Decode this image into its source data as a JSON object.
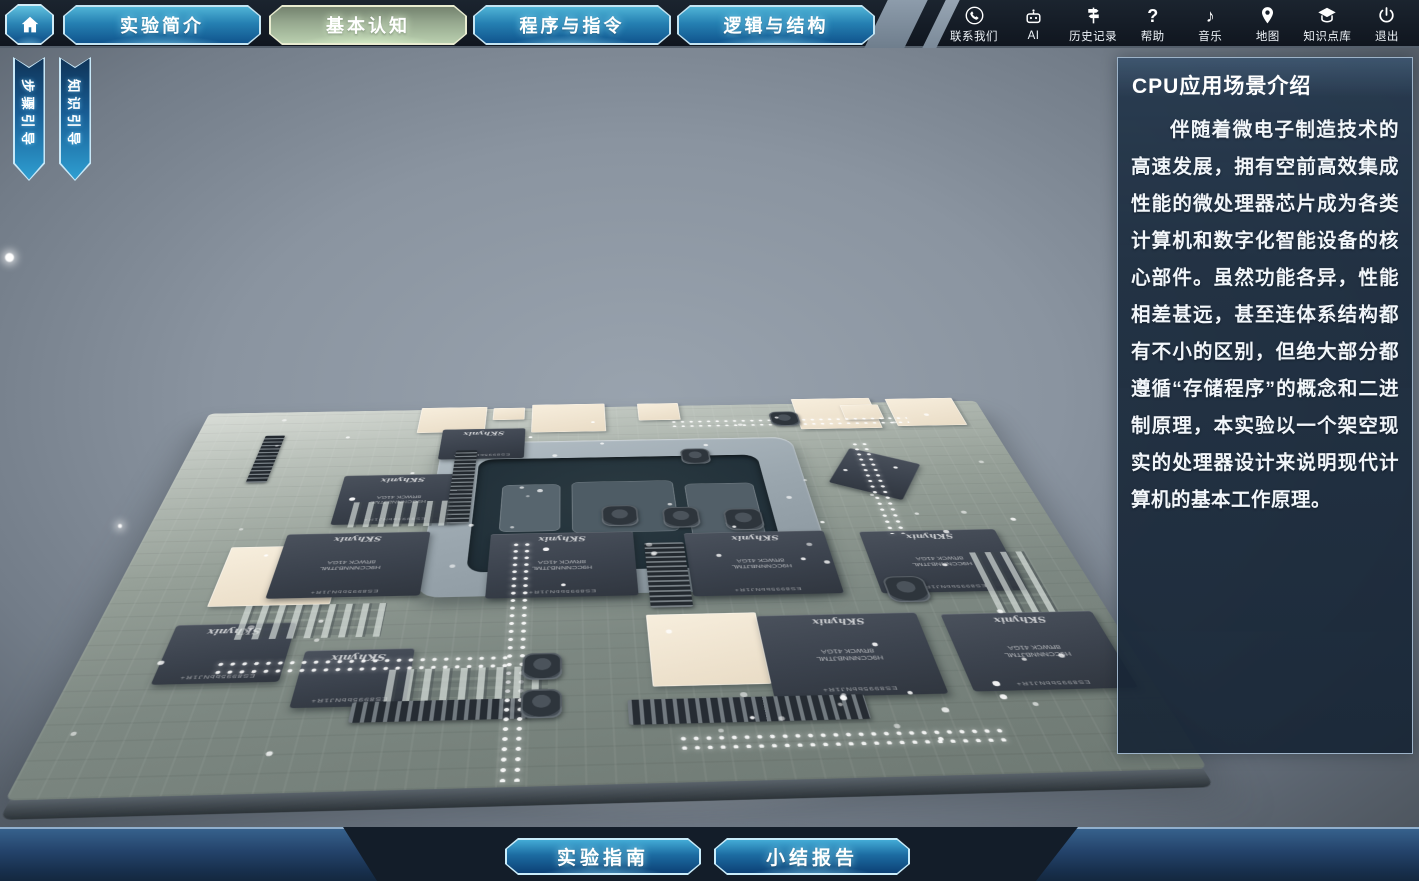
{
  "topbar": {
    "tabs": [
      {
        "label": "实验简介",
        "active": false
      },
      {
        "label": "基本认知",
        "active": true
      },
      {
        "label": "程序与指令",
        "active": false
      },
      {
        "label": "逻辑与结构",
        "active": false
      }
    ],
    "utilities": [
      {
        "label": "联系我们",
        "icon": "contact-phone-icon"
      },
      {
        "label": "AI",
        "icon": "ai-robot-icon"
      },
      {
        "label": "历史记录",
        "icon": "history-signpost-icon"
      },
      {
        "label": "帮助",
        "icon": "help-question-icon",
        "glyph": "?"
      },
      {
        "label": "音乐",
        "icon": "music-note-icon",
        "glyph": "♪"
      },
      {
        "label": "地图",
        "icon": "map-pin-icon"
      },
      {
        "label": "知识点库",
        "icon": "knowledge-base-icon"
      },
      {
        "label": "退出",
        "icon": "power-exit-icon"
      }
    ]
  },
  "left_ribbons": [
    {
      "label": "步骤引导"
    },
    {
      "label": "知识引导"
    }
  ],
  "info_panel": {
    "title": "CPU应用场景介绍",
    "body": "伴随着微电子制造技术的高速发展，拥有空前高效集成性能的微处理器芯片成为各类计算机和数字化智能设备的核心部件。虽然功能各异，性能相差甚远，甚至连体系结构都有不小的区别，但绝大部分都遵循“存储程序”的概念和二进制原理，本实验以一个架空现实的处理器设计来说明现代计算机的基本工作原理。"
  },
  "bottom_buttons": [
    {
      "label": "实验指南"
    },
    {
      "label": "小结报告"
    }
  ],
  "board": {
    "chip_brand": "SKhynix",
    "chip_code_line1": "H9CCNNNBJTML",
    "chip_code_line2": "8RWCK 41GA",
    "chip_edge_code": "ES8995bbNJ1R+"
  },
  "colors": {
    "tab_accent": "#c4e4f2",
    "active_tab_glow": "#e2f8d2",
    "panel_border": "#9db3c9",
    "scene_mid": "#8a94a0"
  }
}
